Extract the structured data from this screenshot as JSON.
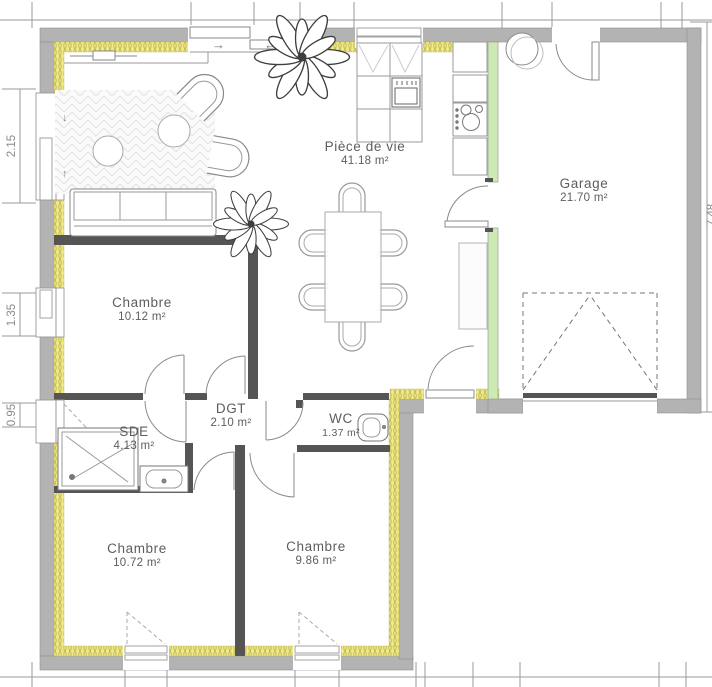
{
  "plan": {
    "rooms": {
      "piece_de_vie": {
        "name": "Pièce de vie",
        "area": "41.18 m²"
      },
      "garage": {
        "name": "Garage",
        "area": "21.70 m²"
      },
      "chambre_nord": {
        "name": "Chambre",
        "area": "10.12 m²"
      },
      "sde": {
        "name": "SDE",
        "area": "4.13 m²"
      },
      "dgt": {
        "name": "DGT",
        "area": "2.10 m²"
      },
      "wc": {
        "name": "WC",
        "area": "1.37 m²"
      },
      "chambre_sud_ouest": {
        "name": "Chambre",
        "area": "10.72 m²"
      },
      "chambre_sud": {
        "name": "Chambre",
        "area": "9.86 m²"
      }
    },
    "dimensions": {
      "left": [
        "2.15",
        "1.35",
        "0.95"
      ],
      "right_clipped": "7.48"
    },
    "arrows": {
      "slide_right": "→",
      "slide_left": "←",
      "window_down": "↓",
      "window_up": "↑"
    },
    "colors": {
      "exterior_wall": "#b3b3b3",
      "insulation": "#efe98a",
      "partition_green": "#cdeab5",
      "interior_wall": "#555555"
    }
  }
}
